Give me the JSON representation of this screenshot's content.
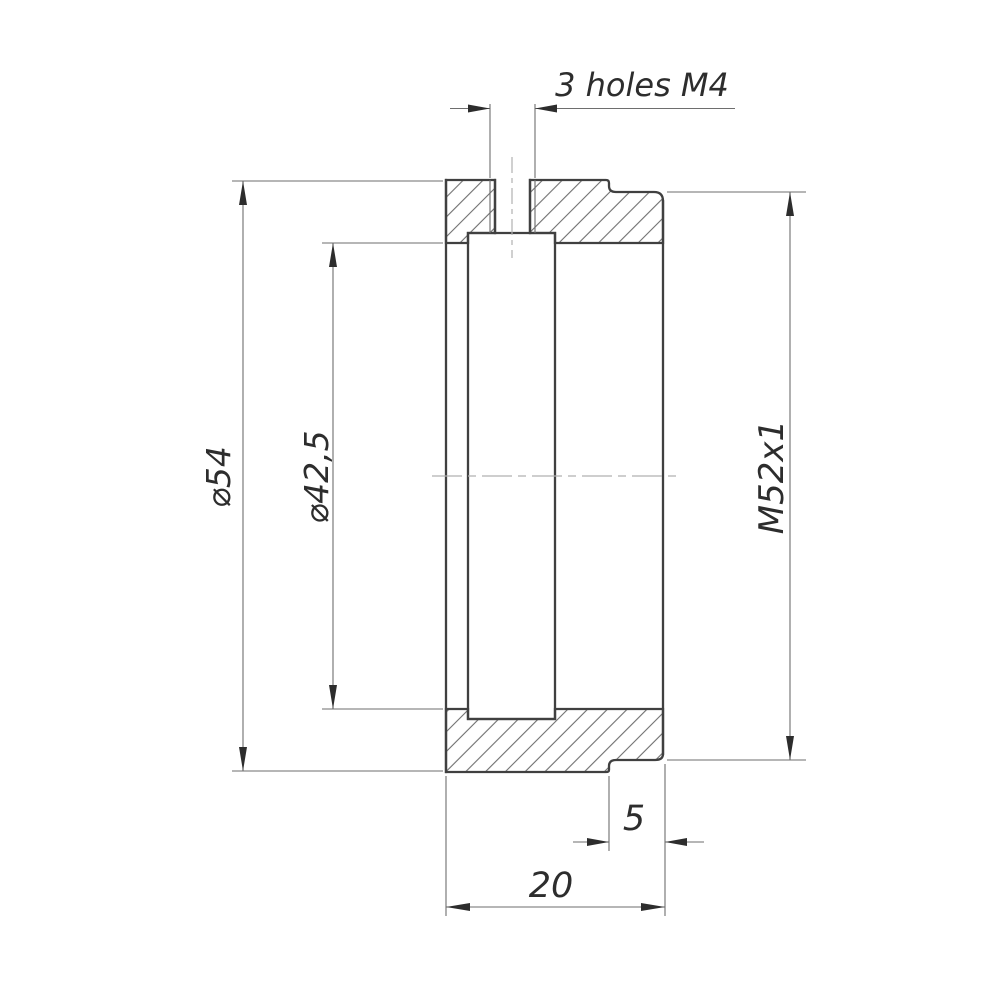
{
  "drawing": {
    "labels": {
      "holes": "3 holes M4",
      "outer_diameter": "⌀54",
      "bore_diameter": "⌀42,5",
      "thread": "M52x1",
      "thread_length": "5",
      "overall_length": "20"
    },
    "colors": {
      "outline": "#404040",
      "thin": "#6e6e6e",
      "centerline": "#b0b0b0",
      "text": "#2d2d2d",
      "bg": "#ffffff"
    }
  }
}
